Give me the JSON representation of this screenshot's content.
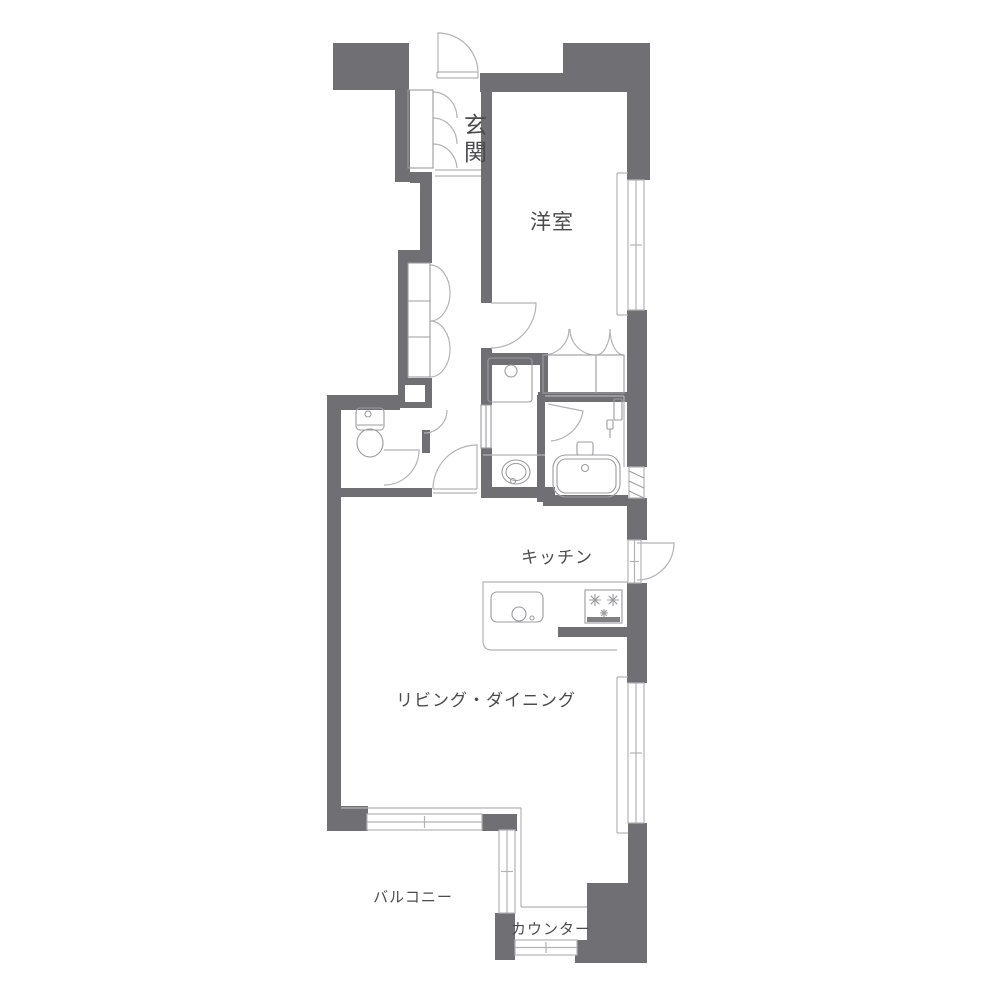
{
  "title": "apartment-floor-plan",
  "colors": {
    "background": "#ffffff",
    "wall": "#6f6f74",
    "line": "#b3b3b6",
    "fixture": "#9c9ca0",
    "grill": "#808084",
    "text": "#4b4b4e"
  },
  "labels": [
    {
      "name": "genkan",
      "text": "玄関",
      "x": 476,
      "y": 133,
      "size": 23,
      "vertical": true
    },
    {
      "name": "yoshitsu",
      "text": "洋室",
      "x": 552,
      "y": 229,
      "size": 21,
      "vertical": false
    },
    {
      "name": "kitchen",
      "text": "キッチン",
      "x": 557,
      "y": 563,
      "size": 17,
      "vertical": false
    },
    {
      "name": "living-dining",
      "text": "リビング・ダイニング",
      "x": 486,
      "y": 706,
      "size": 17,
      "vertical": false
    },
    {
      "name": "balcony",
      "text": "バルコニー",
      "x": 413,
      "y": 902,
      "size": 15,
      "vertical": false
    },
    {
      "name": "counter",
      "text": "カウンター",
      "x": 551,
      "y": 934,
      "size": 15,
      "vertical": false
    }
  ],
  "plan": {
    "walls": [
      [
        333,
        43,
        76,
        47
      ],
      [
        563,
        43,
        87,
        30
      ],
      [
        627,
        43,
        23,
        137
      ],
      [
        480,
        73,
        147,
        19
      ],
      [
        481,
        90,
        11,
        213
      ],
      [
        481,
        348,
        11,
        57
      ],
      [
        481,
        448,
        11,
        49
      ],
      [
        395,
        90,
        15,
        92
      ],
      [
        410,
        172,
        22,
        11
      ],
      [
        420,
        183,
        12,
        80
      ],
      [
        398,
        250,
        32,
        13
      ],
      [
        398,
        263,
        10,
        115
      ],
      [
        398,
        378,
        34,
        30
      ],
      [
        327,
        395,
        73,
        15
      ],
      [
        327,
        395,
        14,
        417
      ],
      [
        327,
        806,
        41,
        25
      ],
      [
        340,
        488,
        92,
        9
      ],
      [
        422,
        430,
        8,
        23
      ],
      [
        481,
        353,
        67,
        12
      ],
      [
        540,
        353,
        8,
        42
      ],
      [
        538,
        392,
        109,
        10
      ],
      [
        537,
        395,
        8,
        107
      ],
      [
        481,
        487,
        74,
        11
      ],
      [
        543,
        495,
        85,
        11
      ],
      [
        627,
        310,
        20,
        157
      ],
      [
        627,
        498,
        20,
        42
      ],
      [
        627,
        583,
        20,
        100
      ],
      [
        628,
        823,
        19,
        140
      ],
      [
        587,
        883,
        60,
        80
      ],
      [
        575,
        940,
        72,
        23
      ],
      [
        495,
        913,
        20,
        47
      ],
      [
        482,
        814,
        35,
        17
      ],
      [
        558,
        627,
        70,
        10
      ]
    ],
    "white_rects": [
      [
        405,
        385,
        20,
        17
      ]
    ],
    "windows": [
      [
        628,
        180,
        16,
        130
      ],
      [
        628,
        683,
        16,
        140
      ],
      [
        367,
        814,
        115,
        16
      ],
      [
        499,
        830,
        16,
        83
      ],
      [
        515,
        940,
        62,
        15
      ],
      [
        628,
        540,
        13,
        43
      ]
    ],
    "louver_rect": [
      629,
      467,
      15,
      31
    ],
    "door_paths": [
      "M438 73 L438 33 A40 40 0 0 1 478 73",
      "M433 92 A24 26 0 0 1 457 118",
      "M433 118 A24 26 0 0 1 457 144",
      "M433 144 A24 26 0 0 1 457 168",
      "M430 265 A20 28 0 0 1 450 293",
      "M430 321 A20 28 0 0 0 450 293",
      "M430 321 A20 28 0 0 1 450 349",
      "M430 377 A20 28 0 0 0 450 349",
      "M491 303 L536 303 A45 45 0 0 1 491 348",
      "M543 355 A26 26 0 0 0 569 329",
      "M596 355 A26 26 0 0 1 570 329",
      "M596 355 A14 26 0 0 0 610 329",
      "M624 355 A14 26 0 0 1 610 329",
      "M548 404 L583 411 A36 36 0 0 1 551 441",
      "M384 450 L419 450 A35 35 0 0 1 384 485",
      "M477 489 L477 445 A44 44 0 0 0 433 489",
      "M637 543 L674 543 A37 37 0 0 1 637 580",
      "M447 410 A23 23 0 0 1 424 433"
    ],
    "thin_lines": [
      [
        617,
        173,
        617,
        315
      ],
      [
        617,
        173,
        628,
        173
      ],
      [
        617,
        315,
        628,
        315
      ],
      [
        617,
        677,
        617,
        833
      ],
      [
        617,
        677,
        628,
        677
      ],
      [
        617,
        833,
        628,
        833
      ],
      [
        341,
        808,
        521,
        808
      ],
      [
        521,
        808,
        521,
        907
      ],
      [
        521,
        907,
        587,
        907
      ],
      [
        435,
        170,
        481,
        170
      ],
      [
        435,
        176,
        481,
        176
      ],
      [
        437,
        72,
        478,
        72
      ],
      [
        437,
        78,
        478,
        78
      ],
      [
        437,
        72,
        437,
        78
      ],
      [
        478,
        72,
        478,
        78
      ],
      [
        433,
        489,
        477,
        489
      ],
      [
        433,
        493,
        477,
        493
      ],
      [
        483,
        455,
        545,
        455
      ],
      [
        545,
        396,
        624,
        396
      ],
      [
        624,
        396,
        624,
        467
      ]
    ],
    "light_paths": [
      "M628 582 L483 582 L483 641 Q483 650 492 650 L617 650"
    ],
    "fixture_rects": [
      [
        408,
        90,
        25,
        78,
        0
      ],
      [
        408,
        263,
        22,
        114,
        0
      ],
      [
        543,
        355,
        81,
        38,
        0
      ],
      [
        356,
        408,
        28,
        22,
        4
      ],
      [
        488,
        358,
        44,
        44,
        3
      ],
      [
        553,
        455,
        67,
        42,
        13
      ],
      [
        557,
        459,
        59,
        34,
        9
      ],
      [
        577,
        442,
        16,
        13,
        2
      ],
      [
        614,
        399,
        8,
        21,
        1
      ],
      [
        607,
        420,
        6,
        9,
        1
      ],
      [
        491,
        592,
        52,
        30,
        6
      ],
      [
        585,
        590,
        37,
        33,
        0
      ],
      [
        481,
        405,
        10,
        43,
        0
      ]
    ],
    "filled_rects": [
      [
        587,
        617,
        33,
        5
      ]
    ],
    "fixture_ellipses": [
      [
        370,
        443,
        13,
        14
      ],
      [
        516,
        472,
        14,
        12
      ],
      [
        516,
        472,
        10,
        8.5
      ]
    ],
    "fixture_circles": [
      [
        368,
        414,
        3
      ],
      [
        511,
        371,
        6
      ],
      [
        585,
        468,
        3.5
      ],
      [
        513,
        481,
        2.5
      ],
      [
        519,
        614,
        7
      ],
      [
        532,
        618,
        2
      ]
    ],
    "fixture_lines": [
      [
        357,
        425,
        383,
        425
      ],
      [
        610,
        429,
        610,
        438
      ],
      [
        596,
        355,
        596,
        393
      ],
      [
        408,
        301,
        430,
        301
      ],
      [
        408,
        337,
        430,
        337
      ],
      [
        486,
        405,
        486,
        448
      ]
    ],
    "fixture_paths": [
      "M589 600 L601 600 M595 594 L595 606 M590.8 595.8 L599.2 604.2 M599.2 595.8 L590.8 604.2",
      "M607 600 L619 600 M613 594 L613 606 M608.8 595.8 L617.2 604.2 M617.2 595.8 L608.8 604.2",
      "M600 613 L608 613 M604 609 L604 617 M601.2 610.2 L606.8 615.8 M606.8 610.2 L601.2 615.8",
      "M629 471 L644 478 M629 481 L644 488 M629 491 L644 498"
    ]
  }
}
